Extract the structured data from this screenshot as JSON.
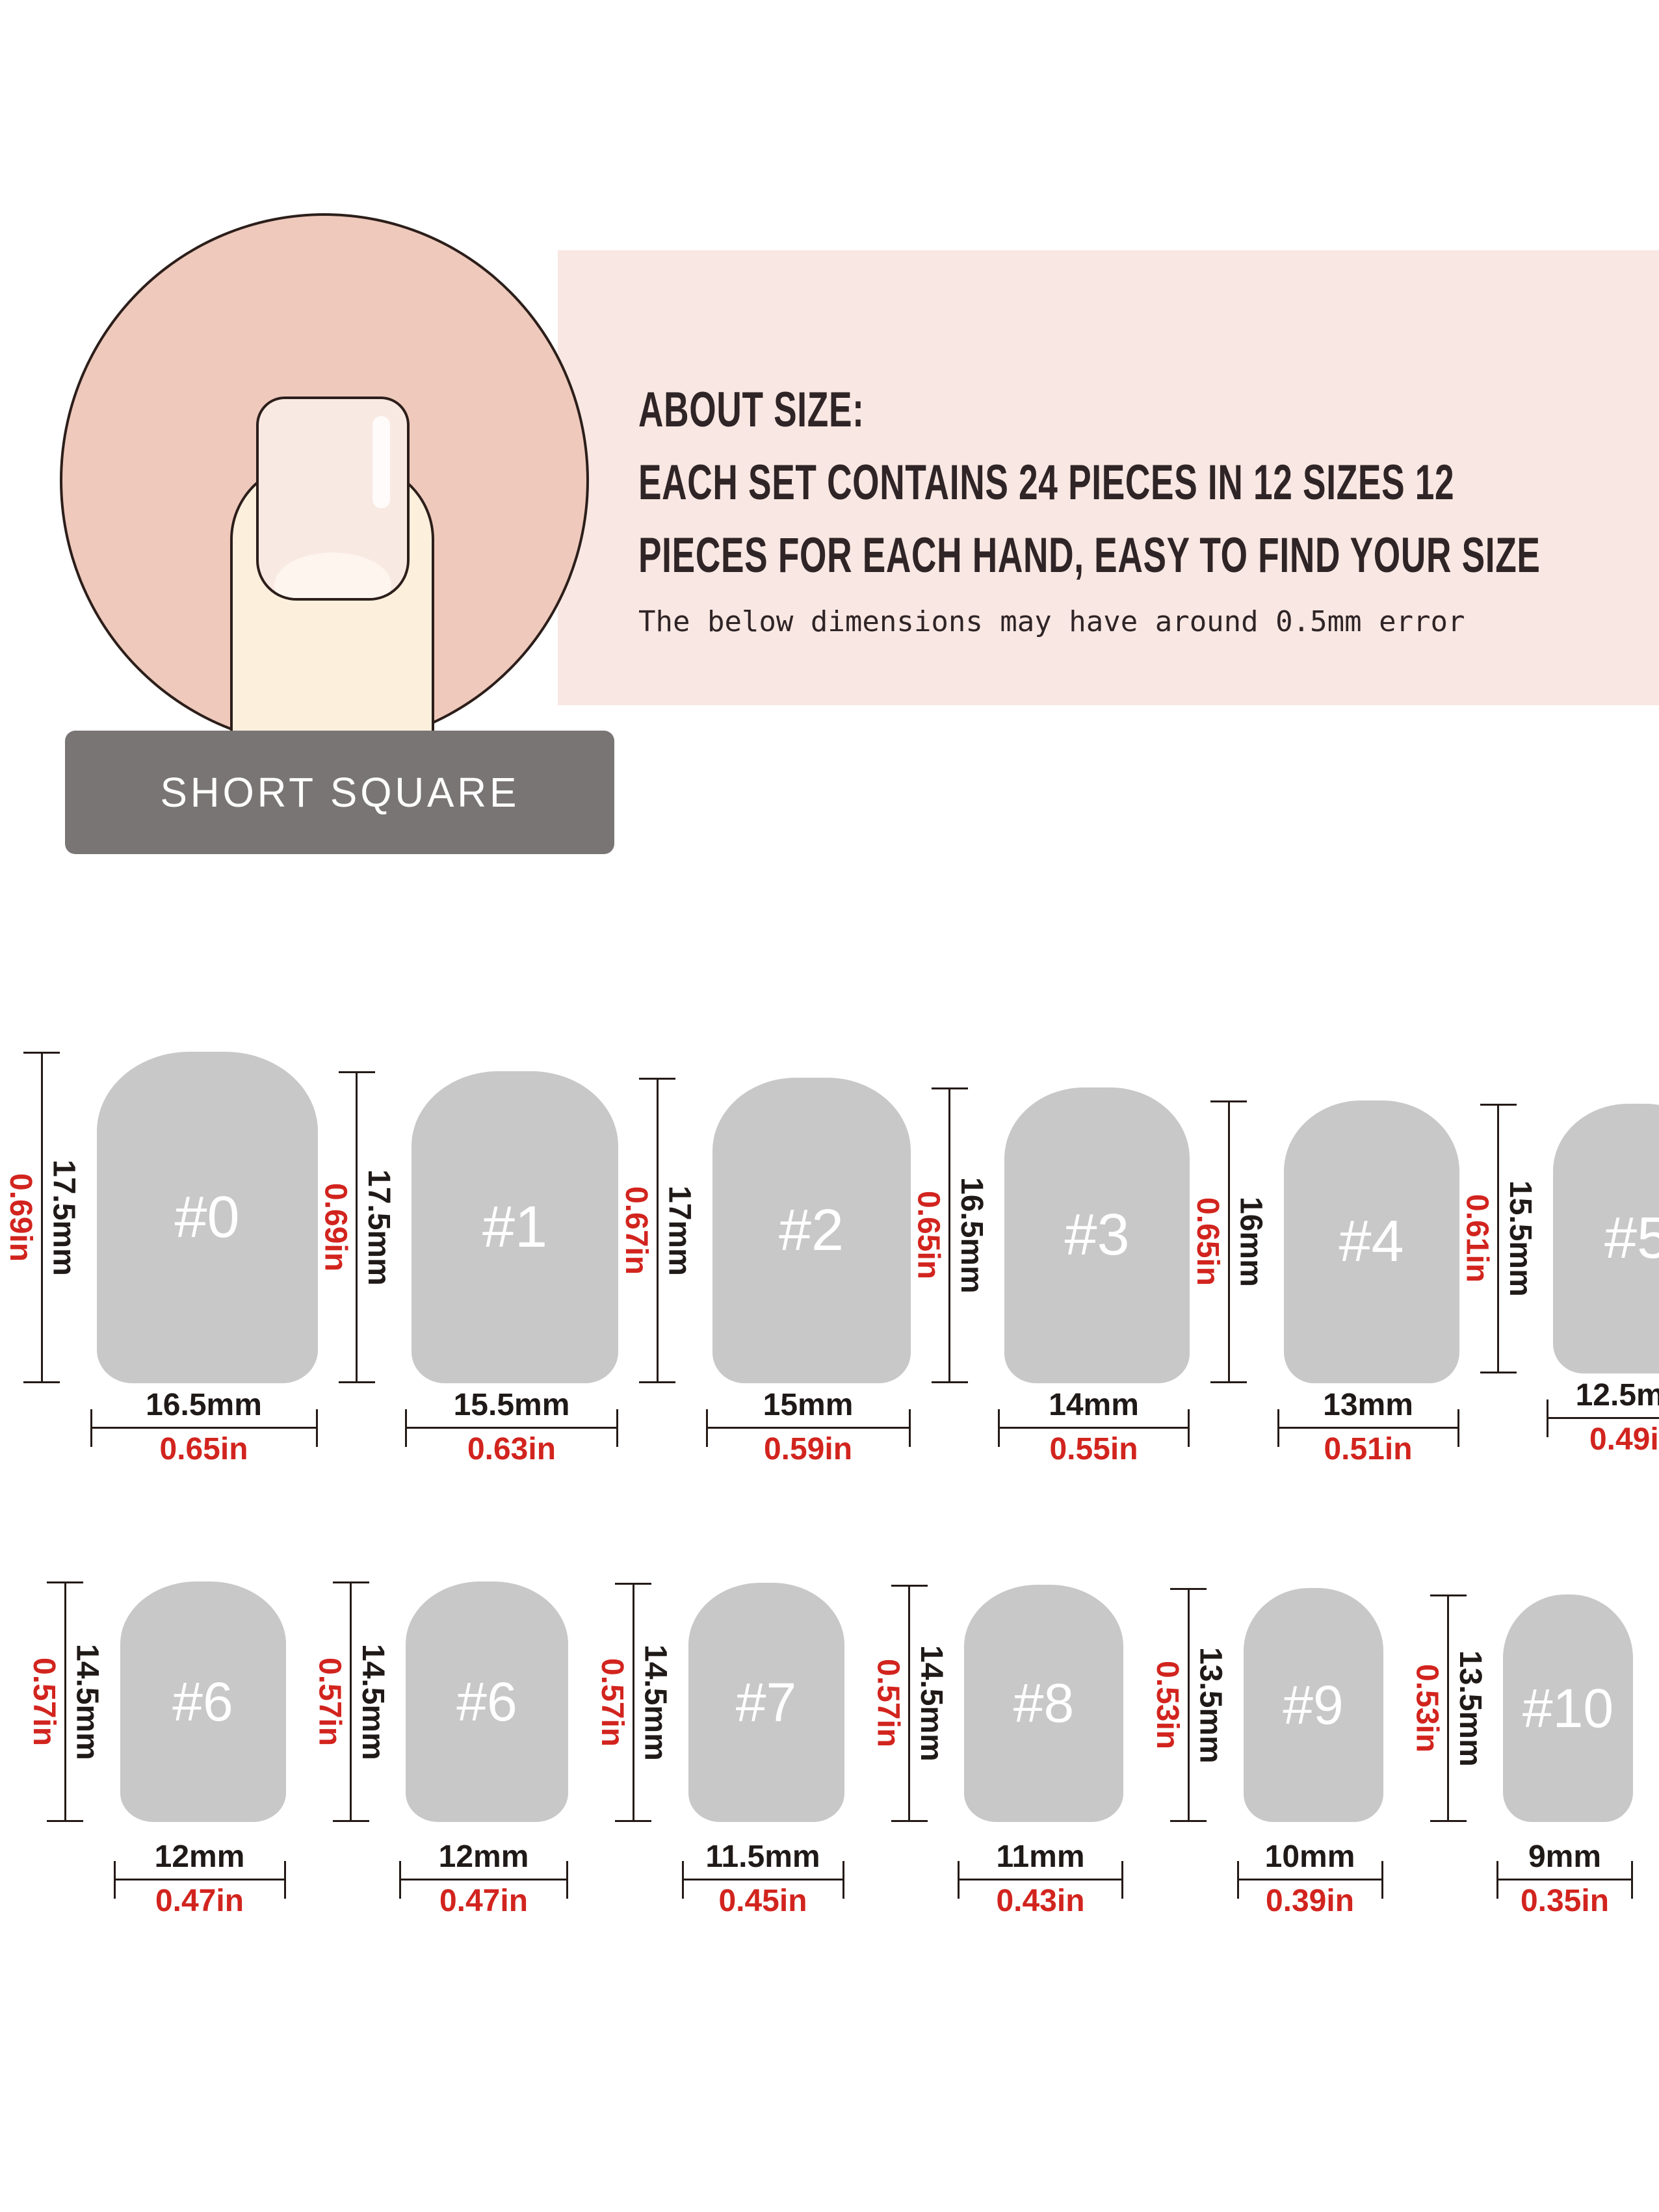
{
  "header": {
    "shape_label": "SHORT SQUARE",
    "about_title": "ABOUT SIZE:",
    "about_line2": "EACH SET CONTAINS 24 PIECES IN 12 SIZES 12",
    "about_line3": "PIECES FOR EACH HAND, EASY TO FIND YOUR SIZE",
    "about_note": "The below dimensions may have around 0.5mm error"
  },
  "colors": {
    "banner_pink": "#f8e7e2",
    "circle_pink": "#eec9bc",
    "finger_skin": "#fcf0dd",
    "nail_plate": "#f9e9e3",
    "outline_dark": "#2c1e1a",
    "label_gray": "#7a7575",
    "nail_gray": "#c8c8c8",
    "measure_black": "#1f1a18",
    "measure_red": "#d2241e"
  },
  "rows": [
    [
      {
        "label": "#0",
        "height_mm": "17.5mm",
        "height_in": "0.69in",
        "width_mm": "16.5mm",
        "width_in": "0.65in"
      },
      {
        "label": "#1",
        "height_mm": "17.5mm",
        "height_in": "0.69in",
        "width_mm": "15.5mm",
        "width_in": "0.63in"
      },
      {
        "label": "#2",
        "height_mm": "17mm",
        "height_in": "0.67in",
        "width_mm": "15mm",
        "width_in": "0.59in"
      },
      {
        "label": "#3",
        "height_mm": "16.5mm",
        "height_in": "0.65in",
        "width_mm": "14mm",
        "width_in": "0.55in"
      },
      {
        "label": "#4",
        "height_mm": "16mm",
        "height_in": "0.65in",
        "width_mm": "13mm",
        "width_in": "0.51in"
      },
      {
        "label": "#5",
        "height_mm": "15.5mm",
        "height_in": "0.61in",
        "width_mm": "12.5mm",
        "width_in": "0.49in"
      }
    ],
    [
      {
        "label": "#6",
        "height_mm": "14.5mm",
        "height_in": "0.57in",
        "width_mm": "12mm",
        "width_in": "0.47in"
      },
      {
        "label": "#6",
        "height_mm": "14.5mm",
        "height_in": "0.57in",
        "width_mm": "12mm",
        "width_in": "0.47in"
      },
      {
        "label": "#7",
        "height_mm": "14.5mm",
        "height_in": "0.57in",
        "width_mm": "11.5mm",
        "width_in": "0.45in"
      },
      {
        "label": "#8",
        "height_mm": "14.5mm",
        "height_in": "0.57in",
        "width_mm": "11mm",
        "width_in": "0.43in"
      },
      {
        "label": "#9",
        "height_mm": "13.5mm",
        "height_in": "0.53in",
        "width_mm": "10mm",
        "width_in": "0.39in"
      },
      {
        "label": "#10",
        "height_mm": "13.5mm",
        "height_in": "0.53in",
        "width_mm": "9mm",
        "width_in": "0.35in"
      }
    ]
  ]
}
